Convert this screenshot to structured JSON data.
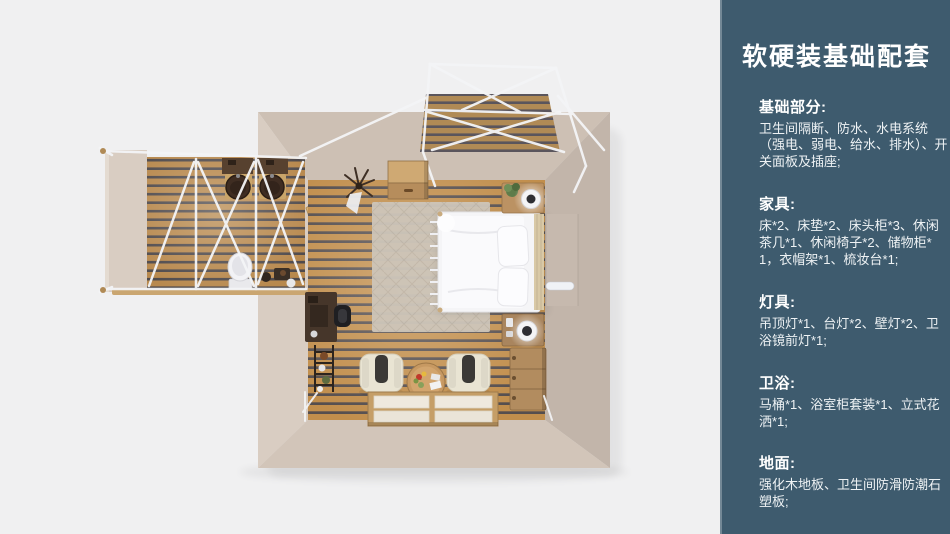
{
  "panel": {
    "title": "软硬装基础配套",
    "sections": [
      {
        "heading": "基础部分:",
        "body": "卫生间隔断、防水、水电系统（强电、弱电、给水、排水）、开关面板及插座;"
      },
      {
        "heading": "家具:",
        "body": "床*2、床垫*2、床头柜*3、休闲茶几*1、休闲椅子*2、储物柜*1，衣帽架*1、梳妆台*1;"
      },
      {
        "heading": "灯具:",
        "body": "吊顶灯*1、台灯*2、壁灯*2、卫浴镜前灯*1;"
      },
      {
        "heading": "卫浴:",
        "body": "马桶*1、浴室柜套装*1、立式花洒*1;"
      },
      {
        "heading": "地面:",
        "body": "强化木地板、卫生间防滑防潮石塑板;"
      }
    ]
  },
  "floorplan": {
    "type": "top-down 3D room render",
    "rooms": [
      "主卧室",
      "卫生间",
      "露台"
    ],
    "furniture": [
      "双人床",
      "床头柜*2",
      "台灯*2",
      "储物柜",
      "梳妆台",
      "休闲椅子*2",
      "休闲茶几",
      "地台床",
      "五斗柜",
      "衣帽架",
      "马桶",
      "浴室柜双盆",
      "置物架"
    ]
  },
  "colors": {
    "background": "#f0f0f1",
    "panel_bg": "#3e5b6e",
    "wall": "#cec1b5",
    "wood_plank": "#c18e4c",
    "wood_gap": "#554e4e",
    "frame_white": "#f4f5f7"
  }
}
